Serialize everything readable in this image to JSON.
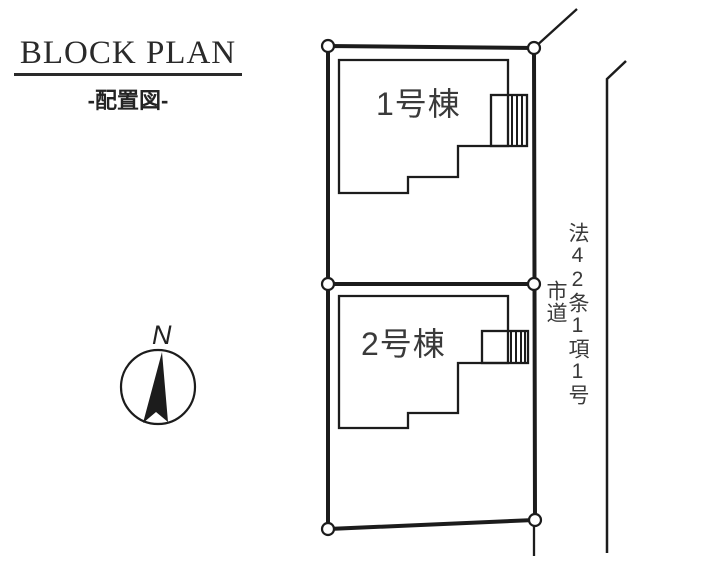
{
  "title": "BLOCK PLAN",
  "subtitle": "-配置図-",
  "compass": {
    "north_label": "N"
  },
  "plots": {
    "building1_label": "1号棟",
    "building2_label": "2号棟"
  },
  "road": {
    "classification": "法42条1項1号",
    "type": "市道"
  },
  "colors": {
    "line": "#1c1c1c",
    "text": "#2a2a2a",
    "background": "#ffffff"
  }
}
